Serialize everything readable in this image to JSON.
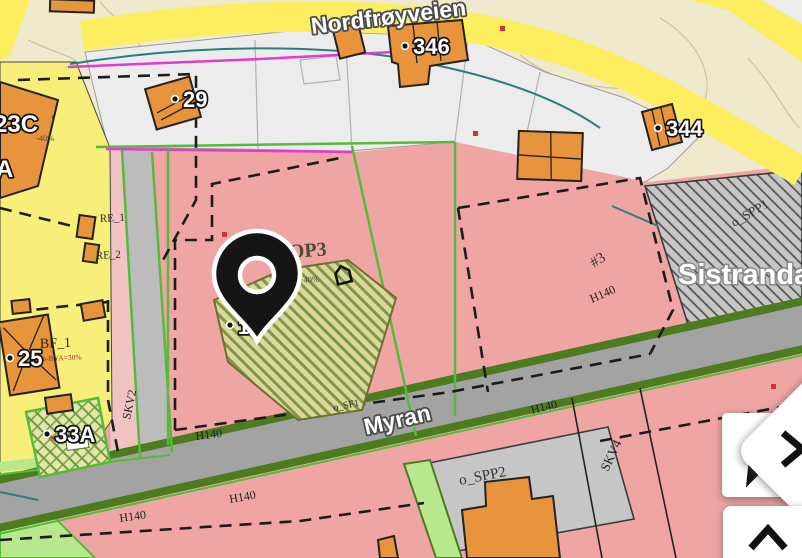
{
  "map": {
    "roads": {
      "nordfroyveien": "Nordfrøyveien",
      "myran": "Myran"
    },
    "place": "Sistranda",
    "zones": {
      "bop3": "BOP3",
      "bya40": "%-BYA=40%",
      "hash3": "#3",
      "o_spp1": "o_SPP1",
      "o_spp2": "o_SPP2",
      "o_sf1": "o_SF1",
      "h140": "H140",
      "skv2": "SKV2",
      "skv4": "SKV4",
      "re1": "RE_1",
      "re2": "RE_2",
      "bf1": "BF_1",
      "bya30": "%-BYA=30%",
      "minus40": "-40%",
      "one": "1"
    },
    "buildings": {
      "n346": "346",
      "n29": "29",
      "n344": "344",
      "n25": "25",
      "n33a": "33A",
      "n19": "19",
      "n23c": "23C",
      "nA": "A"
    },
    "colors": {
      "base_beige": "#efe9cd",
      "parcel_white": "#ececec",
      "zone_pink": "#f0a5a5",
      "zone_yellow": "#f8ef7a",
      "road_yellow": "#fcee5f",
      "building_orange": "#e8943d",
      "road_gray": "#a3a3a3",
      "edge_dark_green": "#4c7c1f",
      "line_green": "#55bb3b",
      "sidewalk_green": "#b9e78d",
      "boundary_magenta": "#e23ad2",
      "utility_teal": "#2a7f7e",
      "parking_gray": "#c6c6c6",
      "pin_black": "#151515",
      "needle_red": "#c0392b"
    }
  },
  "controls": {
    "compass": "compass-needle",
    "expand": "chevron-right",
    "collapse": "chevron-up"
  }
}
